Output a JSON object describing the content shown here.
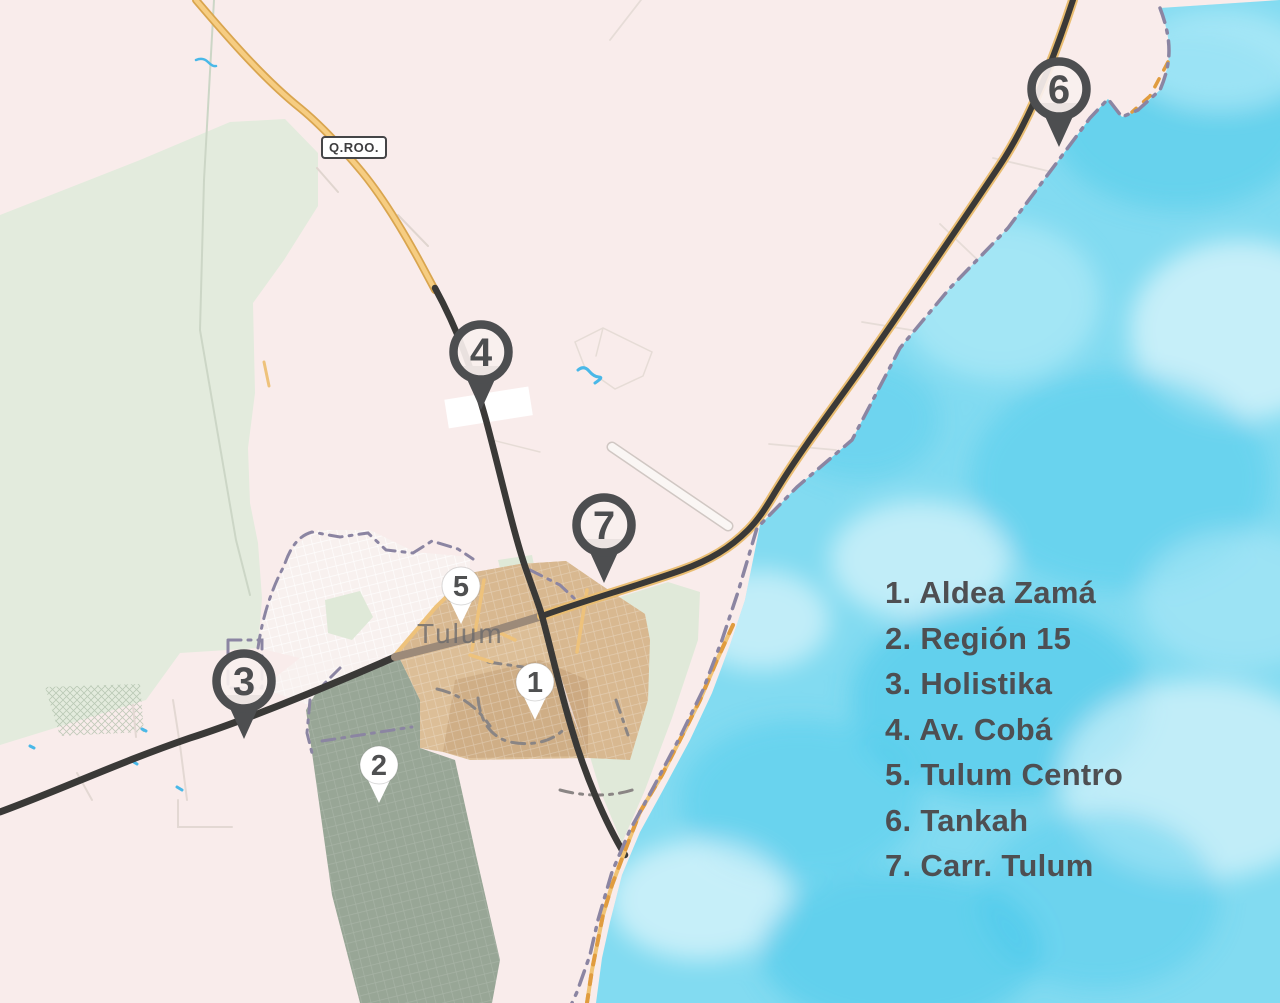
{
  "map": {
    "region_badge": "Q.ROO.",
    "city_label": "Tulum"
  },
  "legend": {
    "items": [
      {
        "number": "1",
        "label": "Aldea Zamá"
      },
      {
        "number": "2",
        "label": "Región 15"
      },
      {
        "number": "3",
        "label": "Holistika"
      },
      {
        "number": "4",
        "label": "Av. Cobá"
      },
      {
        "number": "5",
        "label": "Tulum Centro"
      },
      {
        "number": "6",
        "label": "Tankah"
      },
      {
        "number": "7",
        "label": "Carr. Tulum"
      }
    ]
  },
  "markers": [
    {
      "number": "1",
      "label": "Aldea Zamá",
      "style": "light",
      "x": 535,
      "y": 682
    },
    {
      "number": "2",
      "label": "Región 15",
      "style": "light",
      "x": 379,
      "y": 765
    },
    {
      "number": "3",
      "label": "Holistika",
      "style": "dark",
      "x": 244,
      "y": 681
    },
    {
      "number": "4",
      "label": "Av. Cobá",
      "style": "dark",
      "x": 481,
      "y": 352
    },
    {
      "number": "5",
      "label": "Tulum Centro",
      "style": "light",
      "x": 461,
      "y": 586
    },
    {
      "number": "6",
      "label": "Tankah",
      "style": "dark",
      "x": 1059,
      "y": 89
    },
    {
      "number": "7",
      "label": "Carr. Tulum",
      "style": "dark",
      "x": 604,
      "y": 525
    }
  ],
  "colors": {
    "water": "#82dbf1",
    "land": "#f9eceb",
    "forest": "#e3ebdd",
    "region15_overlay": "#98a696",
    "centro_overlay": "#dcbe97",
    "road_dark": "#3a3937",
    "road_yellow": "#f6cd82",
    "road_brown": "#9c8a79",
    "coast_boundary": "#8b85a2",
    "pin_dark": "#4d4e50",
    "pin_light": "#ffffff",
    "legend_text": "#4e4f52"
  }
}
